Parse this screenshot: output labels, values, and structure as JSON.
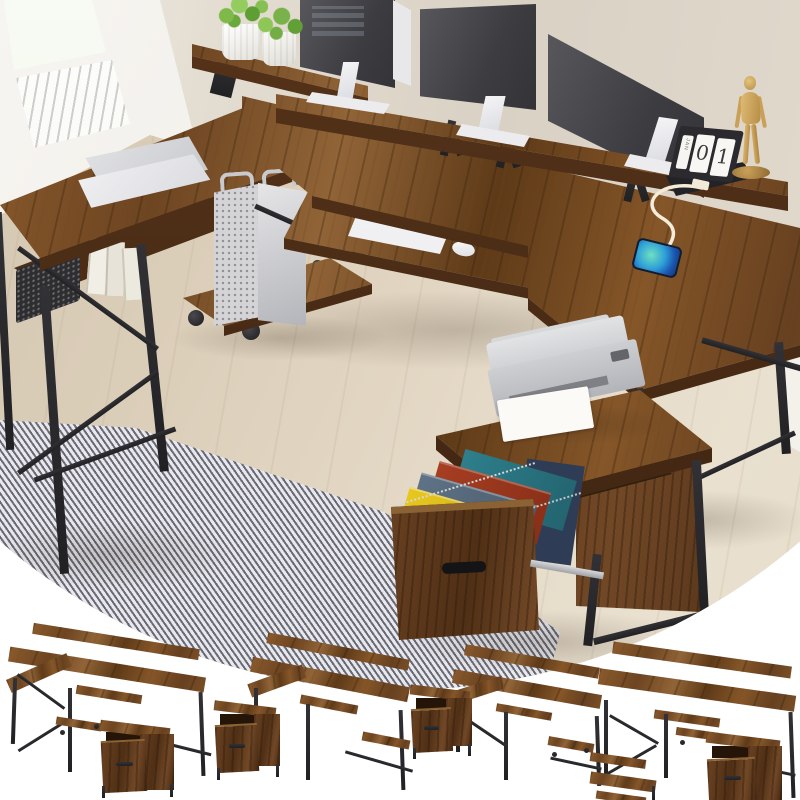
{
  "image": {
    "kind": "ecommerce product photo",
    "subject": "U-shaped rustic wood computer desk with monitor shelf risers, keyboard tray, mobile CPU cart, and printer stand file cabinet",
    "calendar": {
      "month_label": "JAN",
      "digit_left": "0",
      "digit_right": "1"
    }
  },
  "palette": {
    "desk_wood": "#7c5128",
    "desk_wood_dark": "#4a2c12",
    "metal_frame": "#28282b",
    "wall_beige": "#dcd4c7",
    "floor_oak": "#d8cdbb",
    "rug_gray": "#a3a4ac",
    "monitor_screen": "#46464b",
    "folder_yellow": "#e3c51d",
    "folder_red": "#a63e22",
    "folder_teal": "#2e7f8c",
    "folder_gray_blue": "#5f7386",
    "folder_navy": "#2e3d55",
    "phone_screen_blue": "#2b7fd4",
    "plant_green": "#79b24a",
    "mannequin_wood": "#d2ab62"
  },
  "scene_objects": [
    "window-city-view",
    "two-potted-plants",
    "three-monitors",
    "laptop",
    "flip-calendar",
    "wood-mannequin",
    "smartphone-with-charging-cable",
    "white-keyboard",
    "white-mouse",
    "cpu-tower-on-rolling-cart",
    "mesh-storage-basket",
    "books",
    "printer-with-paper",
    "open-file-drawer-with-hanging-folders",
    "gray-herringbone-rug"
  ],
  "gallery": {
    "variants": [
      {
        "label": "U-shaped desk, file cabinet at front"
      },
      {
        "label": "U-shaped desk, file cabinet at left"
      },
      {
        "label": "Reverse U-shaped desk, file cabinet at left"
      },
      {
        "label": "Long desk with monitor shelf, file cabinet at right"
      }
    ]
  }
}
